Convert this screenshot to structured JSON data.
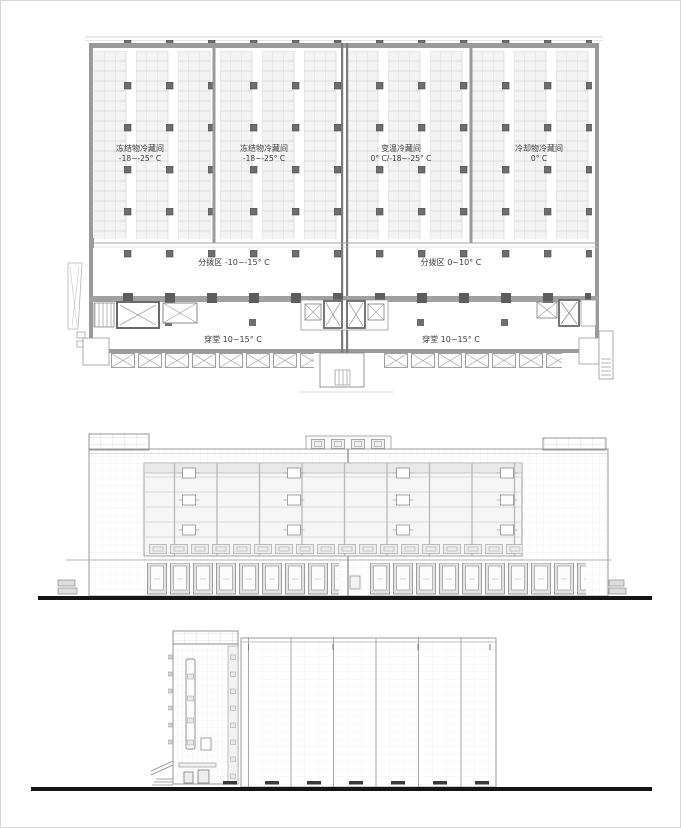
{
  "drawing": {
    "type": "architectural-drawing-set",
    "sheets": [
      "floor-plan",
      "front-elevation",
      "side-elevation"
    ]
  },
  "floor_plan": {
    "rooms": [
      {
        "name": "冻结物冷藏间",
        "temp": "-18~-25° C"
      },
      {
        "name": "冻结物冷藏间",
        "temp": "-18~-25° C"
      },
      {
        "name": "变温冷藏间",
        "temp": "0° C/-18~-25° C"
      },
      {
        "name": "冷却物冷藏间",
        "temp": "0° C"
      }
    ],
    "zones": [
      {
        "label": "分拨区 -10~-15° C"
      },
      {
        "label": "分拨区 0~10° C"
      }
    ],
    "corridors": [
      {
        "label": "穿堂 10~15° C"
      },
      {
        "label": "穿堂 10~15° C"
      }
    ]
  },
  "colors": {
    "line": "#999999",
    "wall": "#9a9a9a",
    "column": "#6e6e6e",
    "ground": "#151515",
    "rack_fill": "#f4f4f4",
    "text": "#3a3a3a"
  }
}
